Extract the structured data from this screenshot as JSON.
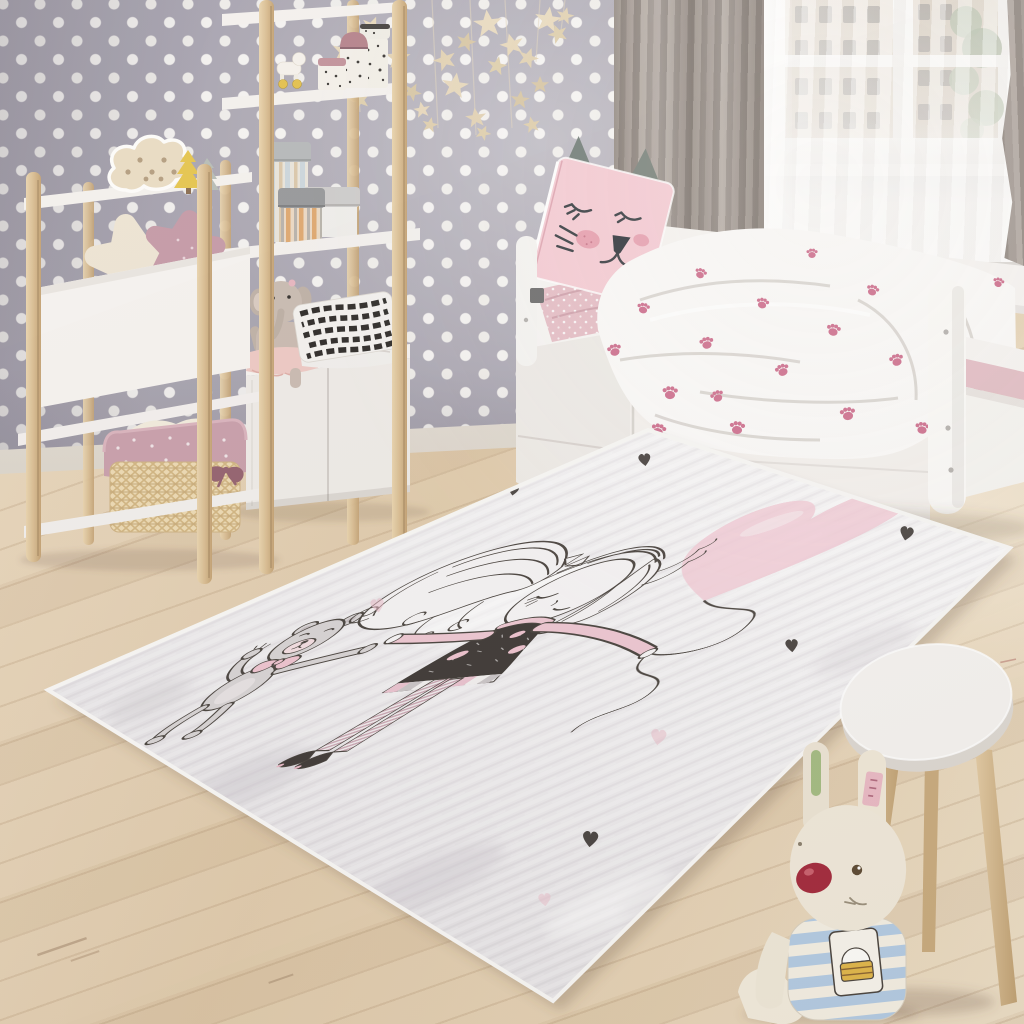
{
  "scene": {
    "description": "Photorealistic render of a pastel children's bedroom: polka-dot lavender wallpaper, two ladder shelving units with toys, a white day bed with cat pillow and paw-print duvet by a window with grey curtains, and a large grey-white kids rug printed with a sketched girl holding a teddy bear and a pink heart balloon; a white stool and plush bunny sit in the foreground.",
    "room": {
      "wallpaper": {
        "label": "lavender-grey wallpaper with white polka dots",
        "base_color": "#a8a4b0",
        "dot_color": "#f4f2f0"
      },
      "floor": {
        "label": "light wooden plank floor",
        "color": "#e3d0b2"
      },
      "window": {
        "label": "window with city buildings and foliage outside",
        "frame_color": "#f1efec",
        "building_color": "#cbb9a4"
      },
      "curtains": {
        "label": "grey curtain panels with white sheer",
        "color": "#a29992"
      }
    },
    "objects": {
      "garland": {
        "label": "hanging star garland",
        "star_color": "#e7d8bc",
        "star_count": 22
      },
      "shelf_left": {
        "label": "white ladder shelf with cloud lamp, tree figurines, star cushions and wicker basket"
      },
      "shelf_tall": {
        "label": "tall white ladder shelf with spotted jars, toy horse, striped hat boxes, plush elephant and striped cushion"
      },
      "cloud_lamp": {
        "label": "wooden cloud marquee lamp",
        "color": "#e9dcc3"
      },
      "star_cushions": {
        "label": "cream and mauve star cushions",
        "colors": [
          "#eee4d3",
          "#c59aa7"
        ]
      },
      "basket": {
        "label": "wicker basket with pink polka-dot liner",
        "colors": [
          "#ecd9b2",
          "#c89fab"
        ]
      },
      "elephant": {
        "label": "plush elephant with pink tutu",
        "color": "#c9bbb1"
      },
      "bed": {
        "label": "white day bed with under-bed drawers",
        "color": "#f6f4f2"
      },
      "cat_pillow": {
        "label": "pink sleeping-cat face pillow",
        "color": "#f5cdd5"
      },
      "duvet": {
        "label": "white duvet with pink paw prints",
        "paw_color": "#cf7190",
        "paw_count": 20
      },
      "sheet": {
        "label": "pink polka-dot fitted sheet",
        "color": "#e6bfc7"
      },
      "rug": {
        "label": "grey-white washed kids rug printed with girl, teddy bear and heart balloon",
        "base_color": "#eceaec",
        "motif": {
          "girl": "sketched girl with curly side ponytail, dark speckled dress, striped stockings",
          "bear": "grey teddy bear with pink bow",
          "balloon": "pink heart balloon on wavy string",
          "accents": "small dark and pink hearts"
        }
      },
      "stool": {
        "label": "round white stool with wooden legs",
        "top_color": "#f5f3f0",
        "leg_color": "#d5ba92"
      },
      "bunny": {
        "label": "plush bunny in blue striped shirt with cake patch",
        "body_color": "#f0e9da",
        "shirt_color": "#b3cbe3",
        "nose_color": "#a32a3c"
      }
    }
  }
}
